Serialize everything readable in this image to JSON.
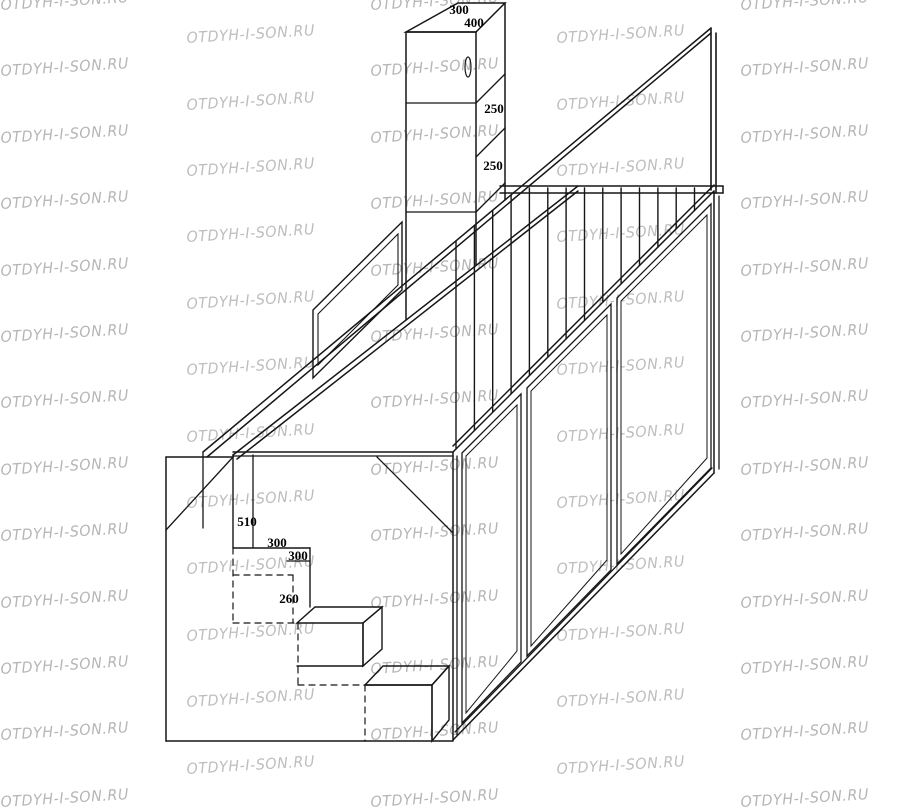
{
  "page": {
    "background": "#ffffff",
    "description": "Isometric assembly drawing of a loft bed (bed over wardrobe) with stairs and safety railing"
  },
  "watermark": {
    "text": "OTDYH-I-SON.RU",
    "color": "#adadad"
  },
  "drawing": {
    "stroke_color": "#161616",
    "dimension_labels": [
      {
        "value": "300",
        "x": 459,
        "y": 14
      },
      {
        "value": "400",
        "x": 474,
        "y": 27
      },
      {
        "value": "250",
        "x": 494,
        "y": 113
      },
      {
        "value": "250",
        "x": 493,
        "y": 170
      },
      {
        "value": "510",
        "x": 247,
        "y": 526
      },
      {
        "value": "300",
        "x": 277,
        "y": 547
      },
      {
        "value": "300",
        "x": 298,
        "y": 560
      },
      {
        "value": "260",
        "x": 289,
        "y": 603
      }
    ]
  }
}
